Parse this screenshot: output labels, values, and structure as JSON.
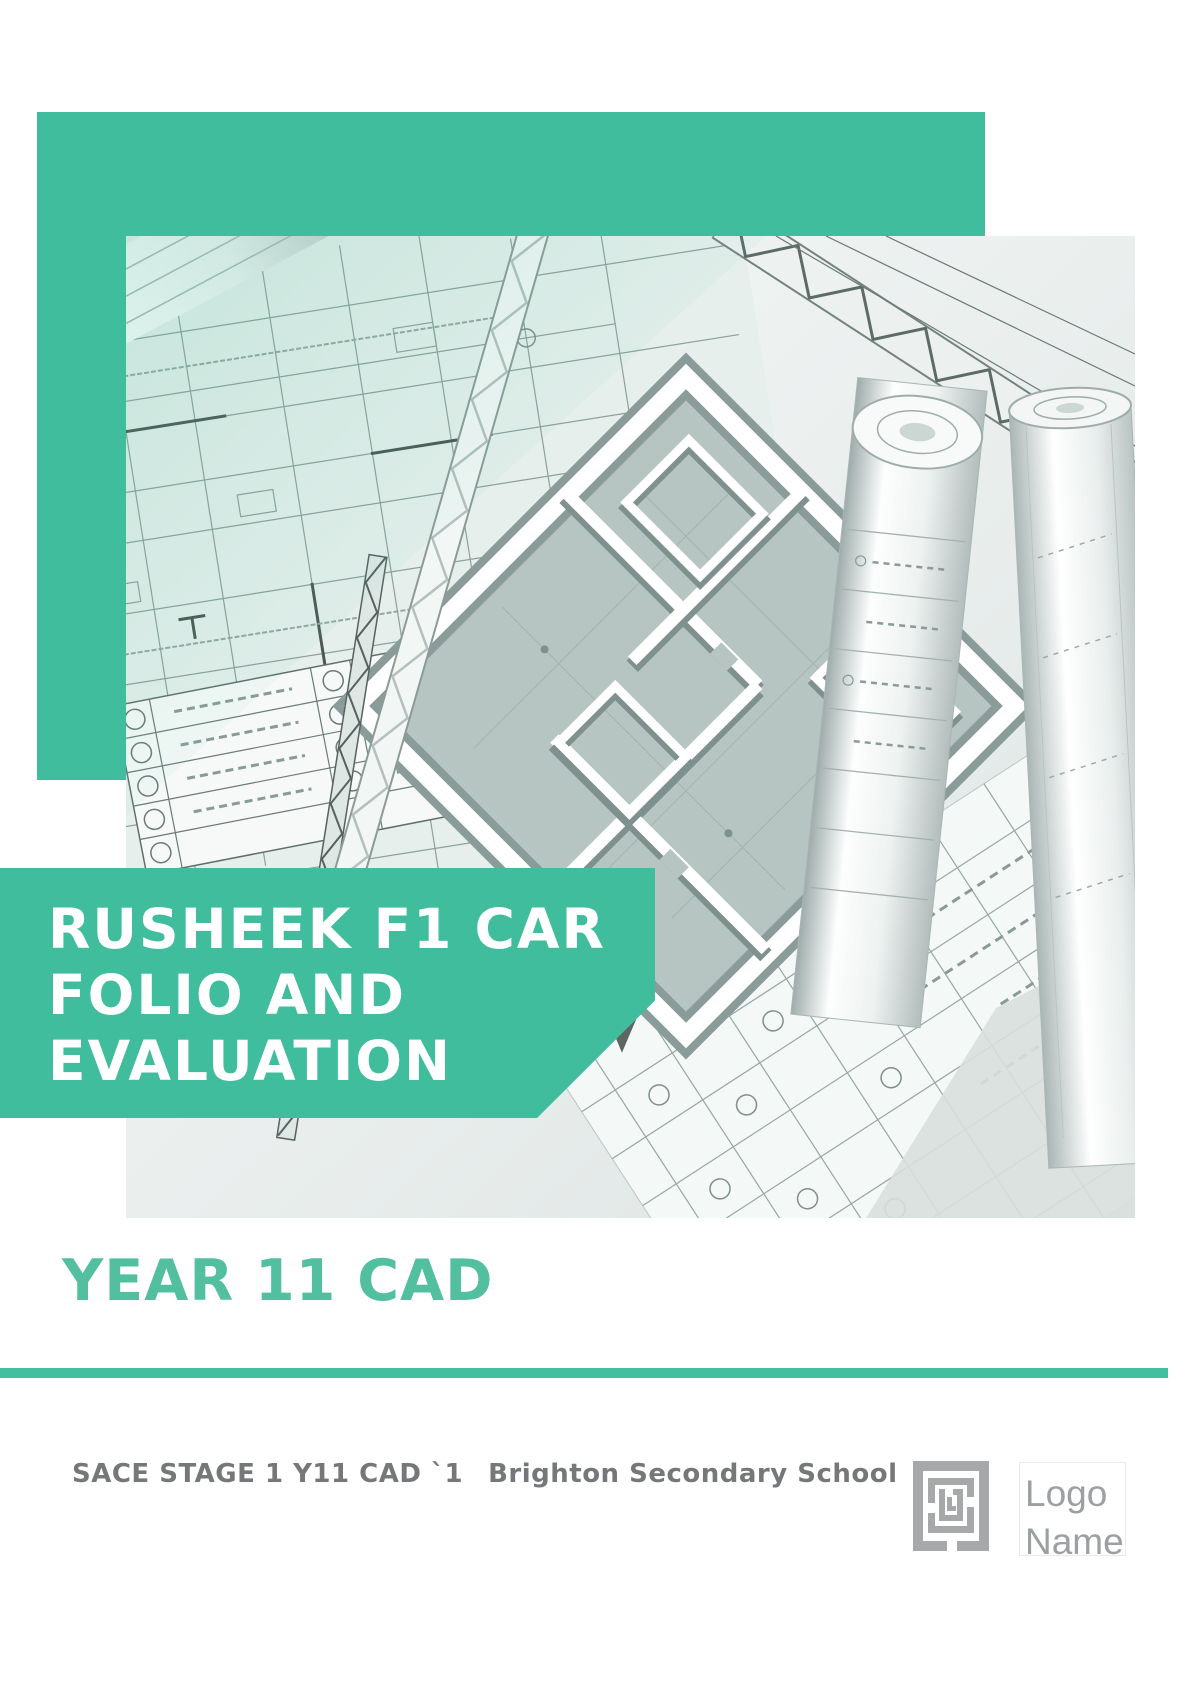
{
  "document_title": {
    "lines": [
      "RUSHEEK F1 CAR",
      "FOLIO AND",
      "EVALUATION"
    ]
  },
  "subtitle": "YEAR 11 CAD",
  "footer": {
    "course": "SACE STAGE 1 Y11 CAD `1",
    "school": "Brighton Secondary School"
  },
  "logo": {
    "line1": "Logo",
    "line2": "Name"
  },
  "icons": {
    "logo": "logo-placeholder-icon",
    "photo": "blueprint-architecture-photo"
  },
  "colors": {
    "accent_teal": "#40BD9C",
    "subtitle_teal": "#52BF9F",
    "banner_text": "#FFFFFF",
    "footer_gray": "#76777A",
    "logo_icon_gray": "#A7A8AA",
    "logo_text_gray": "#9DA0A2"
  }
}
